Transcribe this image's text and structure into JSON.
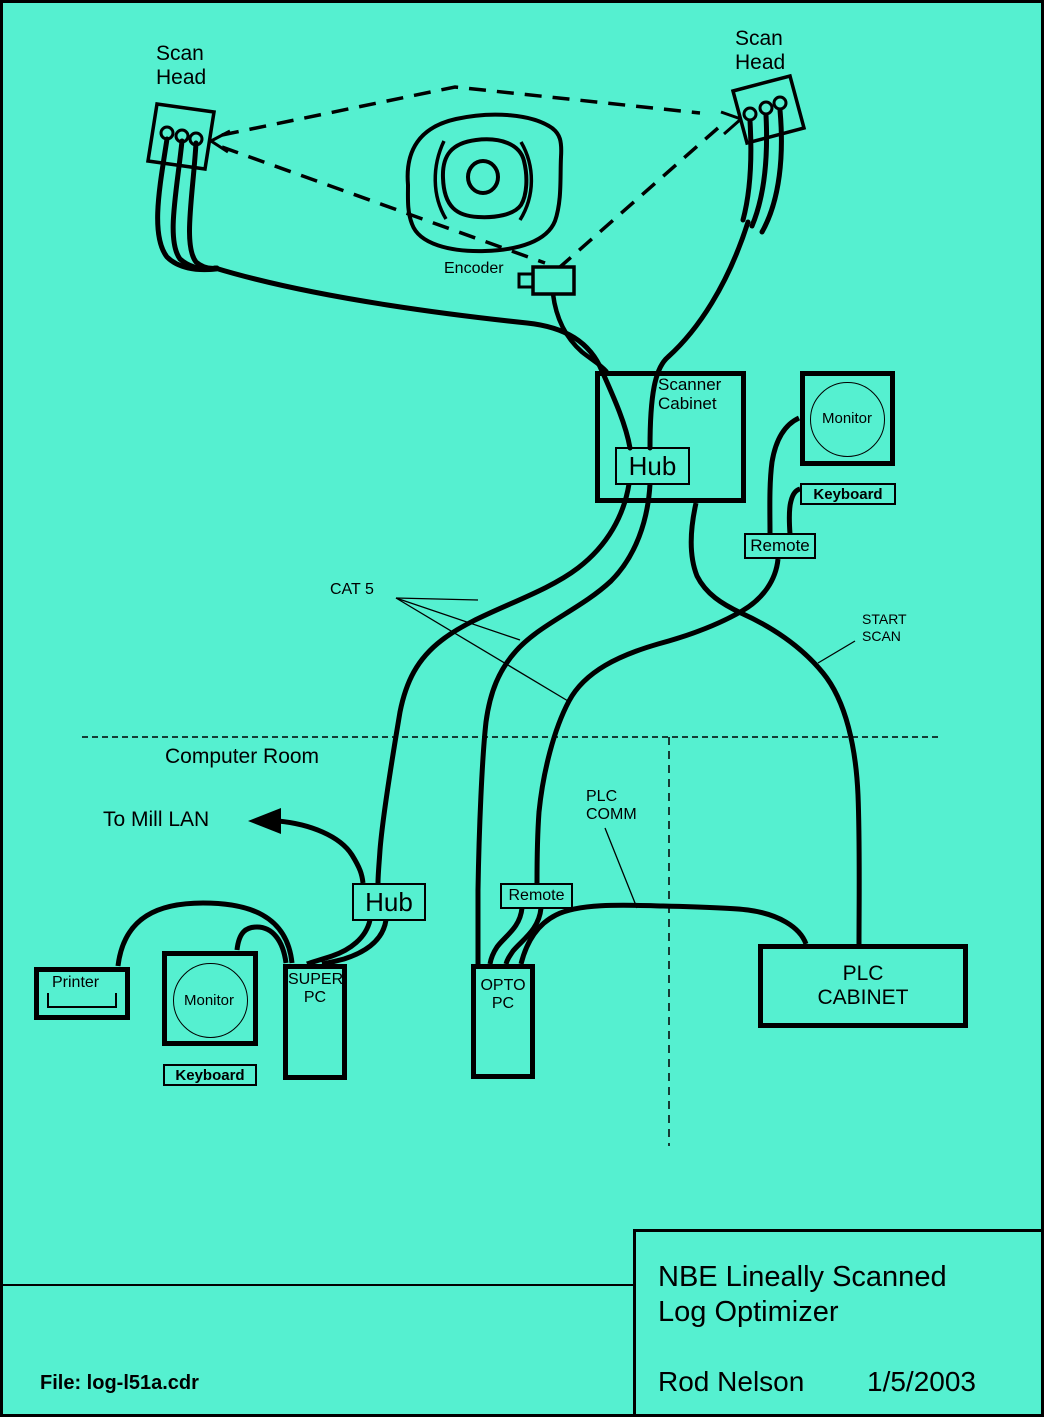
{
  "colors": {
    "background": "#55F0D0",
    "ink": "#000000"
  },
  "scan_heads": {
    "left_label": "Scan\nHead",
    "right_label": "Scan\nHead"
  },
  "log": {
    "encoder_label": "Encoder"
  },
  "scanner_cabinet": {
    "label": "Scanner\nCabinet",
    "hub_label": "Hub"
  },
  "operator_station": {
    "monitor_label": "Monitor",
    "keyboard_label": "Keyboard",
    "remote_label": "Remote"
  },
  "cable_labels": {
    "cat5": "CAT 5",
    "start_scan": "START\nSCAN",
    "plc_comm": "PLC\nCOMM"
  },
  "computer_room": {
    "label": "Computer Room",
    "to_mill_lan_label": "To Mill LAN",
    "hub_label": "Hub",
    "printer_label": "Printer",
    "monitor_label": "Monitor",
    "keyboard_label": "Keyboard",
    "super_pc_label": "SUPER\nPC",
    "remote_label": "Remote",
    "opto_pc_label": "OPTO\nPC"
  },
  "plc": {
    "cabinet_label": "PLC\nCABINET"
  },
  "title_block": {
    "title": "NBE Lineally Scanned\nLog Optimizer",
    "author": "Rod Nelson",
    "date": "1/5/2003"
  },
  "footer": {
    "file_label": "File:  log-l51a.cdr"
  }
}
